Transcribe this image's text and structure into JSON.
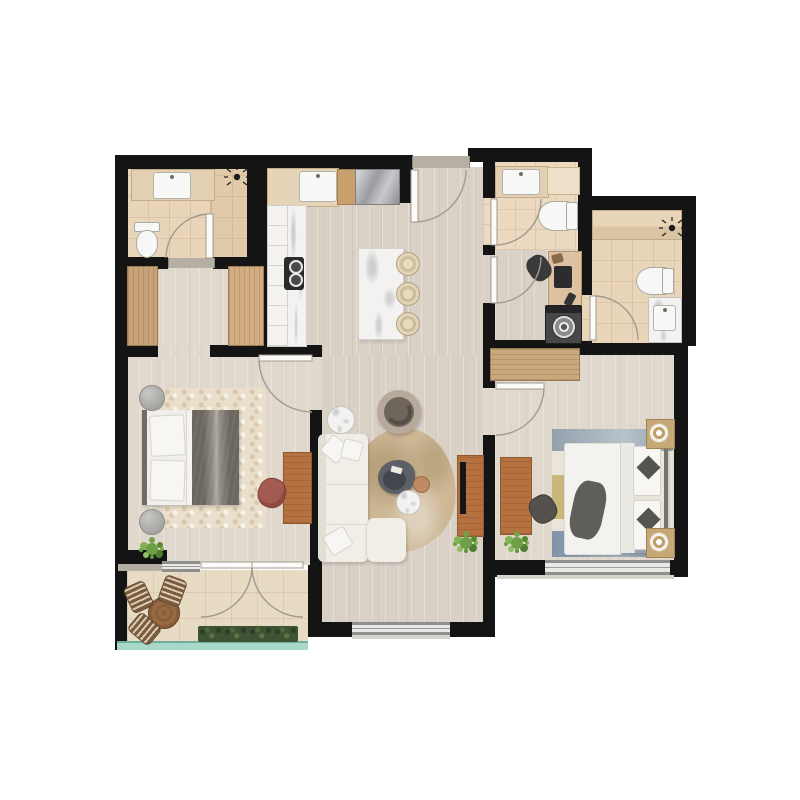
{
  "title": "Apartment Floor Plan",
  "plan": {
    "type": "2-bedroom apartment, top-down rendered floor plan, no text labels",
    "rooms": [
      {
        "id": "bathroom-1",
        "name": "Bathroom 1",
        "fixtures": [
          "vanity with sink",
          "shower head",
          "shower zone",
          "toilet",
          "door"
        ]
      },
      {
        "id": "walk-in-closet",
        "name": "Walk-in Closet",
        "fixtures": [
          "wardrobe left",
          "wardrobe right"
        ]
      },
      {
        "id": "kitchen",
        "name": "Kitchen",
        "fixtures": [
          "upper cabinets with sink",
          "cutting board",
          "refrigerator",
          "side counter with cooktop",
          "marble island",
          "3 bar stools"
        ]
      },
      {
        "id": "entry",
        "name": "Entry Hall",
        "fixtures": [
          "entrance door with swing arc"
        ]
      },
      {
        "id": "living-room",
        "name": "Living Room",
        "furniture": [
          "L-shaped white sofa",
          "ottoman chaise",
          "round armchair",
          "marble side table",
          "organic coffee table",
          "round marble table",
          "terracotta pouf",
          "tan area rug",
          "TV sideboard",
          "TV",
          "plant"
        ]
      },
      {
        "id": "bedroom",
        "name": "Bedroom",
        "furniture": [
          "double bed with gray duvet",
          "2 round stone nightstands",
          "beige area rug",
          "wood desk",
          "mauve chair",
          "plant",
          "door"
        ]
      },
      {
        "id": "bathroom-2",
        "name": "Bathroom 2",
        "fixtures": [
          "vanity with sink",
          "side shelf",
          "toilet",
          "door"
        ]
      },
      {
        "id": "study-laundry",
        "name": "Study / Laundry",
        "fixtures": [
          "desk with laptop",
          "chair",
          "washing machine",
          "door"
        ]
      },
      {
        "id": "bathroom-3",
        "name": "Bathroom 3",
        "fixtures": [
          "shower bench",
          "shower head",
          "toilet",
          "vanity with sink",
          "door"
        ]
      },
      {
        "id": "master-bedroom",
        "name": "Master Bedroom",
        "furniture": [
          "double bed with white duvet",
          "2 nightstands with lamps",
          "banded blue area rug",
          "slatted wardrobe",
          "wood desk",
          "dark chair",
          "plant",
          "door"
        ]
      },
      {
        "id": "balcony",
        "name": "Balcony",
        "furniture": [
          "round wood table",
          "3 striped chairs",
          "planter hedge",
          "glass balustrade",
          "french double doors"
        ]
      }
    ],
    "windows": [
      "bedroom south window",
      "living room south window",
      "master bedroom south window"
    ],
    "icons": [
      "shower-head-icon",
      "faucet-icon",
      "door-swing-arc"
    ],
    "palette": {
      "wall": "#141414",
      "wood_floor": "#d9d1c6",
      "wood_floor_light": "#e0d8cc",
      "tile_floor": "#e9d6ba",
      "balcony_tile": "#e8dbc4",
      "marble": "#f3f2f0",
      "furniture_wood": "#b5713f",
      "wardrobe_wood": "#c9a87e",
      "sofa_white": "#f1eee8",
      "duvet_gray": "#6b675f",
      "accent_chair": "#a35a50",
      "plant_green": "#7fae4f",
      "hedge_green": "#3f5234",
      "glass_teal": "#a8d8ca",
      "rug_tan": "#cdb795",
      "rug_blue": "#8fa0ac",
      "appliance_steel": "#9a9ca0"
    }
  }
}
